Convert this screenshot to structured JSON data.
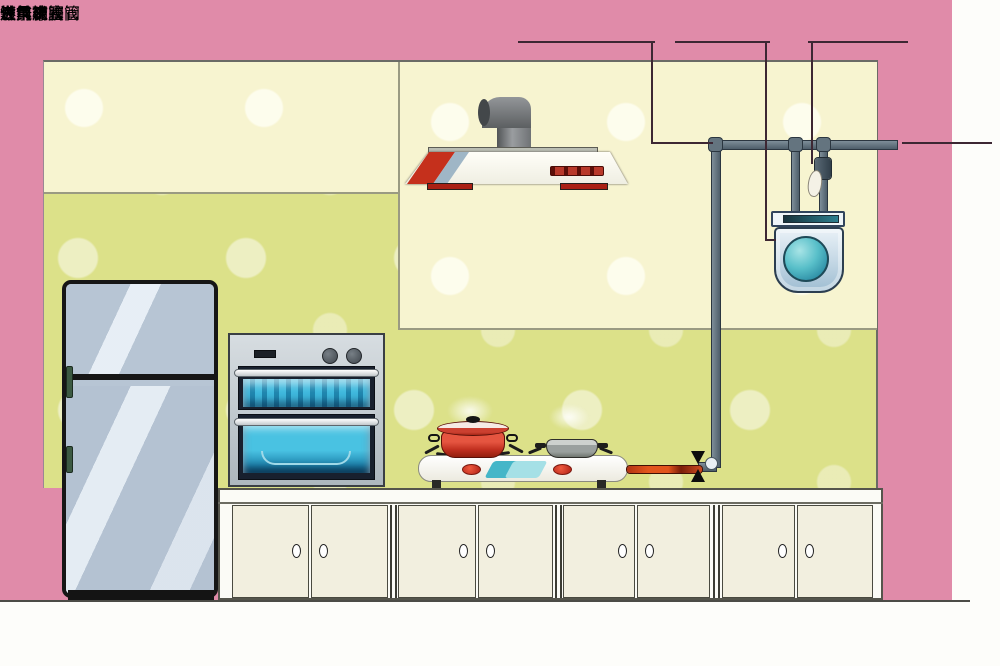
{
  "labels": {
    "galvanized_steel_pipe": "镀锌钢管",
    "gas_meter": "燃气表",
    "pre_meter_ball_valve": "表前球阀",
    "gas_inlet": "进气",
    "stove": "灶具",
    "dedicated_rubber_hose": "专用橡胶管",
    "pre_stove_plug_valve": "灶前旋塞阀"
  },
  "colors": {
    "background_pink": "#e08ba9",
    "wall_upper_cream": "#f7f4d0",
    "wall_lower_green": "#dce189",
    "pipe_gray": "#5b6c79",
    "rubber_hose_orange": "#d94f1e",
    "gas_meter_blue": "#cfe2ee",
    "meter_dial_teal": "#45b4c6",
    "hood_accent_red": "#c5301c",
    "pot_red": "#d8402c",
    "pan_gray": "#a7adad",
    "top_label_text": "#4b2335",
    "watermark_blue": "#8fb8d4"
  }
}
